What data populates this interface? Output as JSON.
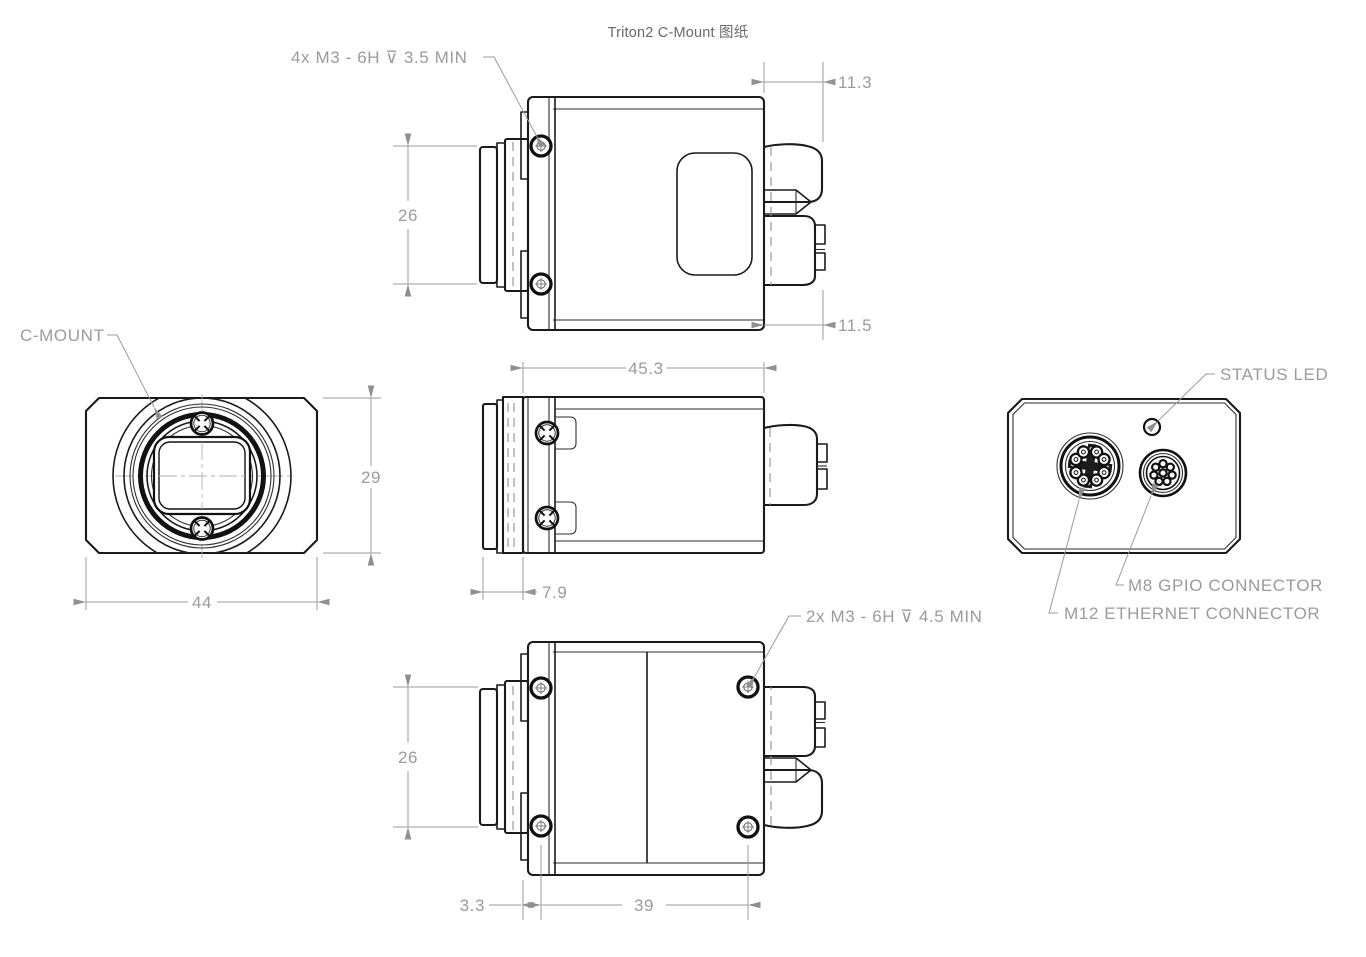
{
  "title": "Triton2 C-Mount 图纸",
  "colors": {
    "edge": "#1a1a1a",
    "dimension": "#9b9b9b",
    "background": "#ffffff"
  },
  "views": {
    "top": {
      "callout": "4x M3 - 6H ⊽ 3.5 MIN",
      "dims": {
        "connector_depth_top": "11.3",
        "connector_depth_bottom": "11.5",
        "hole_spacing": "26"
      }
    },
    "side": {
      "dims": {
        "body_length": "45.3",
        "lens_protrusion": "7.9"
      }
    },
    "front": {
      "label": "C-MOUNT",
      "dims": {
        "height": "29",
        "width": "44"
      }
    },
    "rear": {
      "labels": {
        "status_led": "STATUS LED",
        "m8": "M8 GPIO CONNECTOR",
        "m12": "M12 ETHERNET CONNECTOR"
      }
    },
    "bottom": {
      "callout": "2x M3 - 6H ⊽ 4.5 MIN",
      "dims": {
        "hole_spacing_vertical": "26",
        "flange_offset": "3.3",
        "hole_spacing_horizontal": "39"
      }
    }
  }
}
